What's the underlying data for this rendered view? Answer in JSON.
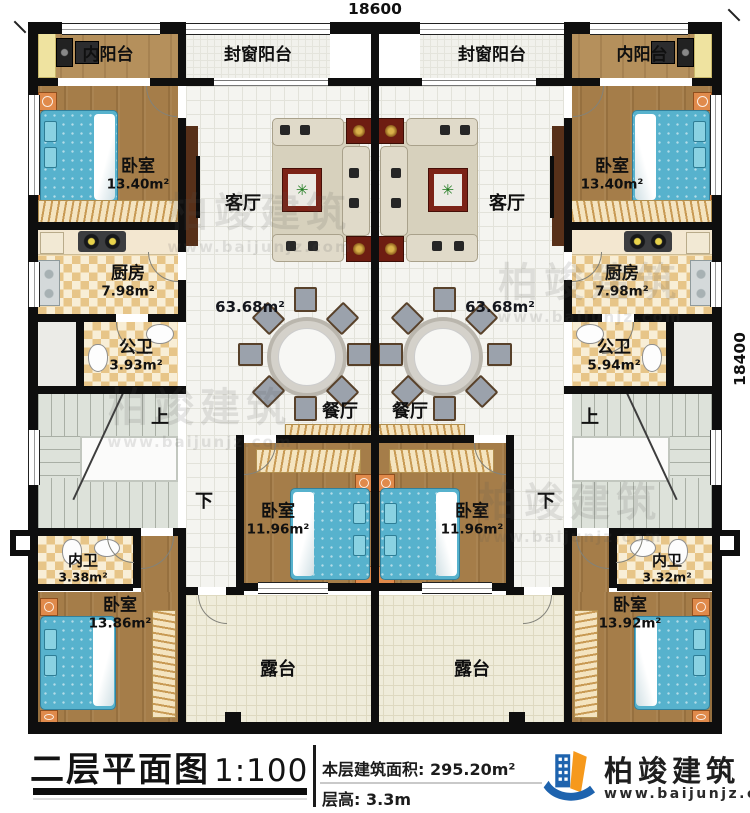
{
  "dimensions": {
    "width": "18600",
    "height": "18400"
  },
  "units": {
    "left": {
      "inner_balcony": "内阳台",
      "window_balcony": "封窗阳台",
      "bedroom_top": {
        "name": "卧室",
        "area": "13.40m²"
      },
      "living": "客厅",
      "floor_area": "63.68m²",
      "kitchen": {
        "name": "厨房",
        "area": "7.98m²"
      },
      "public_bath": {
        "name": "公卫",
        "area": "3.93m²"
      },
      "dining": "餐厅",
      "stairs_up": "上",
      "stairs_down": "下",
      "bedroom_mid": {
        "name": "卧室",
        "area": "11.96m²"
      },
      "ensuite_bath": {
        "name": "内卫",
        "area": "3.38m²"
      },
      "bedroom_bottom": {
        "name": "卧室",
        "area": "13.86m²"
      },
      "terrace": "露台"
    },
    "right": {
      "inner_balcony": "内阳台",
      "window_balcony": "封窗阳台",
      "bedroom_top": {
        "name": "卧室",
        "area": "13.40m²"
      },
      "living": "客厅",
      "floor_area": "63.68m²",
      "kitchen": {
        "name": "厨房",
        "area": "7.98m²"
      },
      "public_bath": {
        "name": "公卫",
        "area": "5.94m²"
      },
      "dining": "餐厅",
      "stairs_up": "上",
      "stairs_down": "下",
      "bedroom_mid": {
        "name": "卧室",
        "area": "11.96m²"
      },
      "ensuite_bath": {
        "name": "内卫",
        "area": "3.32m²"
      },
      "bedroom_bottom": {
        "name": "卧室",
        "area": "13.92m²"
      },
      "terrace": "露台"
    }
  },
  "title_block": {
    "title": "二层平面图",
    "scale": "1:100",
    "area_label": "本层建筑面积:",
    "area_value": "295.20m²",
    "height_label": "层高:",
    "height_value": "3.3m"
  },
  "logo": {
    "name": "柏竣建筑",
    "url": "www.baijunjz.com"
  },
  "watermark": {
    "brand": "柏竣建筑",
    "url": "www.baijunjz.com"
  },
  "colors": {
    "brand_blue": "#1e63ae",
    "brand_orange": "#f6991c",
    "wall": "#0e0e0e",
    "bed_blue": "#57b2cd"
  }
}
